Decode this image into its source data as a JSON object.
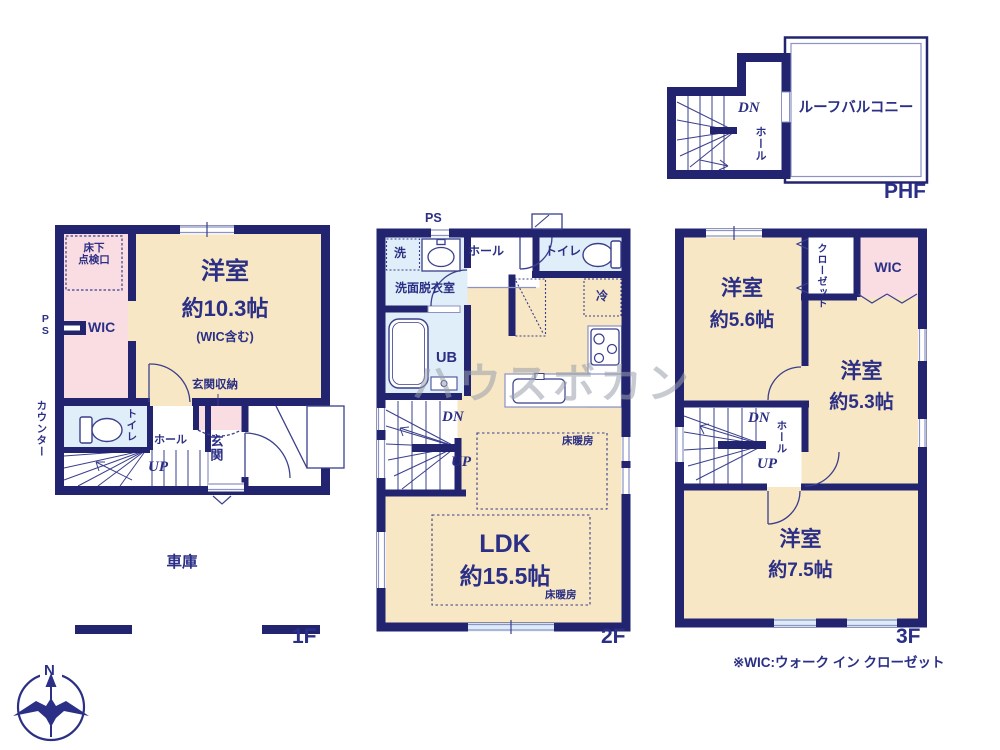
{
  "watermark": "ハウスボカン",
  "compass": {
    "north": "N"
  },
  "footnote": "※WIC:ウォーク イン クローゼット",
  "phf": {
    "floor_label": "PHF",
    "down": "DN",
    "hall": "ホール",
    "roof_balcony": "ルーフバルコニー"
  },
  "f1": {
    "floor_label": "1F",
    "underfloor_hatch": "床下\n点検口",
    "pipe_space": "PS",
    "wic": "WIC",
    "bedroom_name": "洋室",
    "bedroom_size": "約10.3帖",
    "bedroom_note": "(WIC含む)",
    "entrance_storage": "玄関収納",
    "counter": "カウンター",
    "toilet": "トイレ",
    "hall": "ホール",
    "up": "UP",
    "entrance": "玄関",
    "garage": "車庫"
  },
  "f2": {
    "floor_label": "2F",
    "pipe_space": "PS",
    "laundry": "洗",
    "washroom": "洗面脱衣室",
    "hall": "ホール",
    "toilet": "トイレ",
    "unit_bath": "UB",
    "fridge": "冷",
    "down": "DN",
    "up": "UP",
    "ldk_name": "LDK",
    "ldk_size": "約15.5帖",
    "floor_heating": "床暖房"
  },
  "f3": {
    "floor_label": "3F",
    "bedroom1_name": "洋室",
    "bedroom1_size": "約5.6帖",
    "closet": "クローゼット",
    "wic": "WIC",
    "bedroom2_name": "洋室",
    "bedroom2_size": "約5.3帖",
    "down": "DN",
    "hall": "ホール",
    "up": "UP",
    "bedroom3_name": "洋室",
    "bedroom3_size": "約7.5帖"
  }
}
